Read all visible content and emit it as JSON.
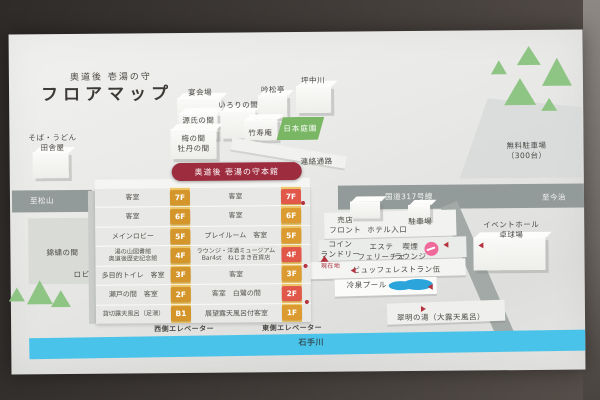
{
  "title": {
    "brand": "奥道後 壱湯の守",
    "heading": "フロアマップ"
  },
  "annex": {
    "soba": "そば・うどん\n田舎屋",
    "banquet": "宴会場",
    "irori": "いろりの間",
    "genji": "源氏の間",
    "ume_botan": "梅の間\n牡丹の間",
    "ginshotei": "吟松亭",
    "tsubonakagawa": "坪中川",
    "chikujuan": "竹寿庵",
    "garden": "日本庭園",
    "corridor": "連絡通路"
  },
  "west_area": {
    "kinshu": "錦繍の間",
    "lobby": "ロビー"
  },
  "roads": {
    "to_matsuyama": "至松山",
    "route317": "国道317号線",
    "to_imabari": "至今治",
    "river": "石手川"
  },
  "building": {
    "banner": "奥道後 壱湯の守本館",
    "west_elevator": "西側エレベーター",
    "east_elevator": "東側エレベーター",
    "current_location": "現在地",
    "rows": [
      {
        "west": "客室",
        "west_floor": "7F",
        "center": "客室",
        "east_floor": "7F"
      },
      {
        "west": "客室",
        "west_floor": "6F",
        "center": "客室",
        "east_floor": "6F"
      },
      {
        "west": "メインロビー",
        "west_floor": "5F",
        "center": "プレイルーム　客室",
        "east_floor": "5F"
      },
      {
        "west": "湯の山図書館\n奥道後歴史記念館",
        "west_floor": "4F",
        "center": "ラウンジ・洋酒ミュージアム\nBar4st　ねじまき百貨店",
        "east_floor": "4F"
      },
      {
        "west": "多目的トイレ　客室",
        "west_floor": "3F",
        "center": "客室",
        "east_floor": "3F"
      },
      {
        "west": "瀬戸の間　客室",
        "west_floor": "2F",
        "center": "客室　白鷺の間",
        "east_floor": "2F"
      },
      {
        "west": "貸切露天風呂（足湯）",
        "west_floor": "B1",
        "center": "展望露天風呂付客室",
        "east_floor": "1F"
      }
    ]
  },
  "grounds": {
    "shop_front": "売店\nフロント",
    "hotel_entrance": "ホテル入口",
    "parking": "駐車場",
    "free_parking": "無料駐車場\n（300台）",
    "coin_laundry": "コイン\nランドリー",
    "esthetic": "エステ\nフェリーチェ",
    "smoking_lounge": "喫煙\nラウンジ",
    "buffet": "ビュッフェレストラン伍",
    "pool": "冷泉プール",
    "open_air_bath": "翠明の湯（大露天風呂）",
    "event_hall": "イベントホール\n卓球場"
  },
  "colors": {
    "floor_chip_yellow": "#d4952b",
    "floor_chip_orange": "#dc9b31",
    "floor_chip_red": "#e1574a",
    "banner_red": "#9d2c3e",
    "garden_green": "#79b765",
    "tree_green": "#8fc584",
    "river_blue": "#49c3e9",
    "pool_blue": "#2ba4dc",
    "road_gray": "#939b9a",
    "marker_red": "#b5333f",
    "smoking_pink": "#ef6a9a"
  }
}
